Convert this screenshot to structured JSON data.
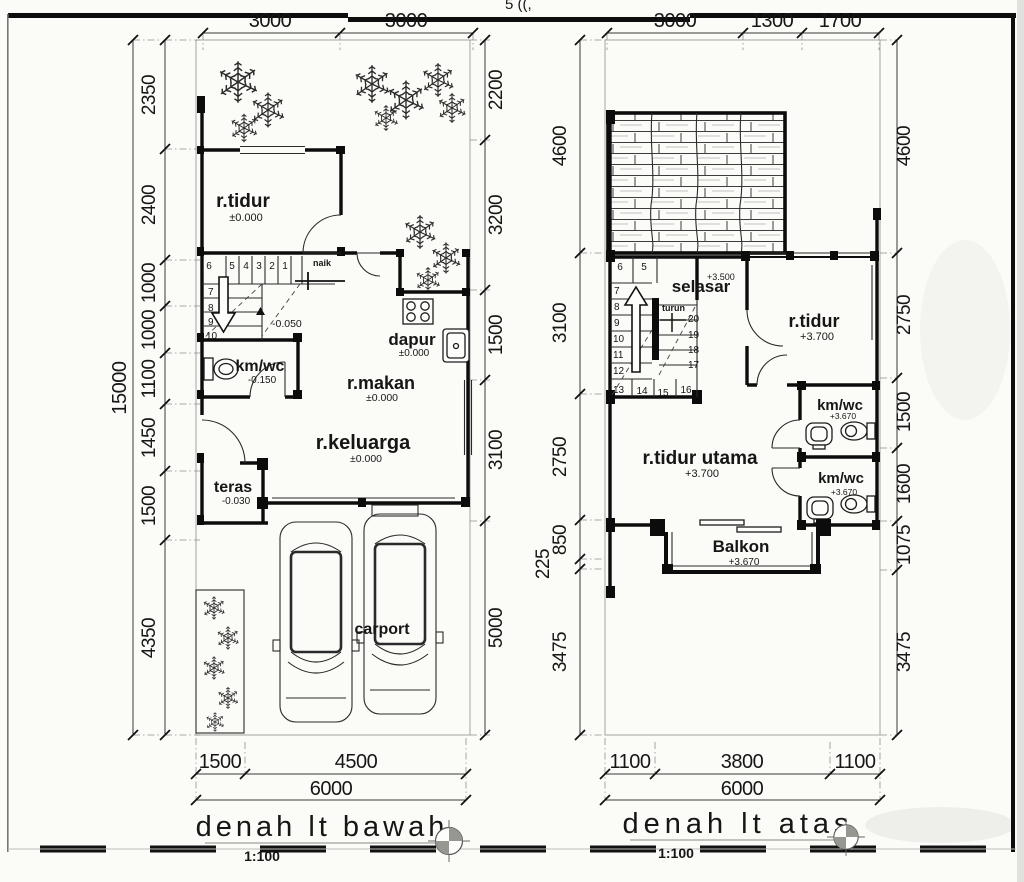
{
  "page": {
    "cropped_top_text": "5 ((,"
  },
  "plans": {
    "bawah": {
      "title": "denah lt bawah",
      "scale": "1:100",
      "dims": {
        "top": [
          "3000",
          "3000"
        ],
        "left": [
          "2350",
          "2400",
          "1000",
          "1000",
          "1100",
          "1450",
          "1500",
          "4350"
        ],
        "left_total": "15000",
        "right": [
          "2200",
          "3200",
          "1500",
          "3100",
          "5000"
        ],
        "bottom": [
          "1500",
          "4500"
        ],
        "bottom_total": "6000"
      },
      "rooms": {
        "rtidur": {
          "label": "r.tidur",
          "level": "±0.000"
        },
        "kmwc": {
          "label": "km/wc",
          "level": "-0.150"
        },
        "dapur": {
          "label": "dapur",
          "level": "±0.000"
        },
        "rmakan": {
          "label": "r.makan",
          "level": "±0.000"
        },
        "rkeluarga": {
          "label": "r.keluarga",
          "level": "±0.000"
        },
        "teras": {
          "label": "teras",
          "level": "-0.030"
        },
        "carport": {
          "label": "carport"
        }
      },
      "stairs": {
        "direction": "naik",
        "landing_level": "-0.050",
        "top_row": [
          "6",
          "5",
          "4",
          "3",
          "2",
          "1"
        ],
        "left_col": [
          "7",
          "8",
          "9",
          "10"
        ]
      }
    },
    "atas": {
      "title": "denah lt atas",
      "scale": "1:100",
      "dims": {
        "top": [
          "3000",
          "1300",
          "1700"
        ],
        "left": [
          "4600",
          "3100",
          "2750",
          "850",
          "225",
          "3475"
        ],
        "right": [
          "4600",
          "2750",
          "1500",
          "1600",
          "1075",
          "3475"
        ],
        "bottom": [
          "1100",
          "3800",
          "1100"
        ],
        "bottom_total": "6000"
      },
      "rooms": {
        "selasar": {
          "label": "selasar",
          "level": "+3.500"
        },
        "rtidur": {
          "label": "r.tidur",
          "level": "+3.700"
        },
        "kmwc1": {
          "label": "km/wc",
          "level": "+3.670"
        },
        "rtidurutama": {
          "label": "r.tidur utama",
          "level": "+3.700"
        },
        "kmwc2": {
          "label": "km/wc",
          "level": "+3.670"
        },
        "balkon": {
          "label": "Balkon",
          "level": "+3.670"
        }
      },
      "stairs": {
        "direction": "turun",
        "top_row": [
          "6",
          "5"
        ],
        "left_col": [
          "7",
          "8",
          "9",
          "10",
          "11",
          "12",
          "13"
        ],
        "bottom_row": [
          "14",
          "15",
          "16"
        ],
        "right_col": [
          "20",
          "19",
          "18",
          "17"
        ]
      }
    }
  }
}
